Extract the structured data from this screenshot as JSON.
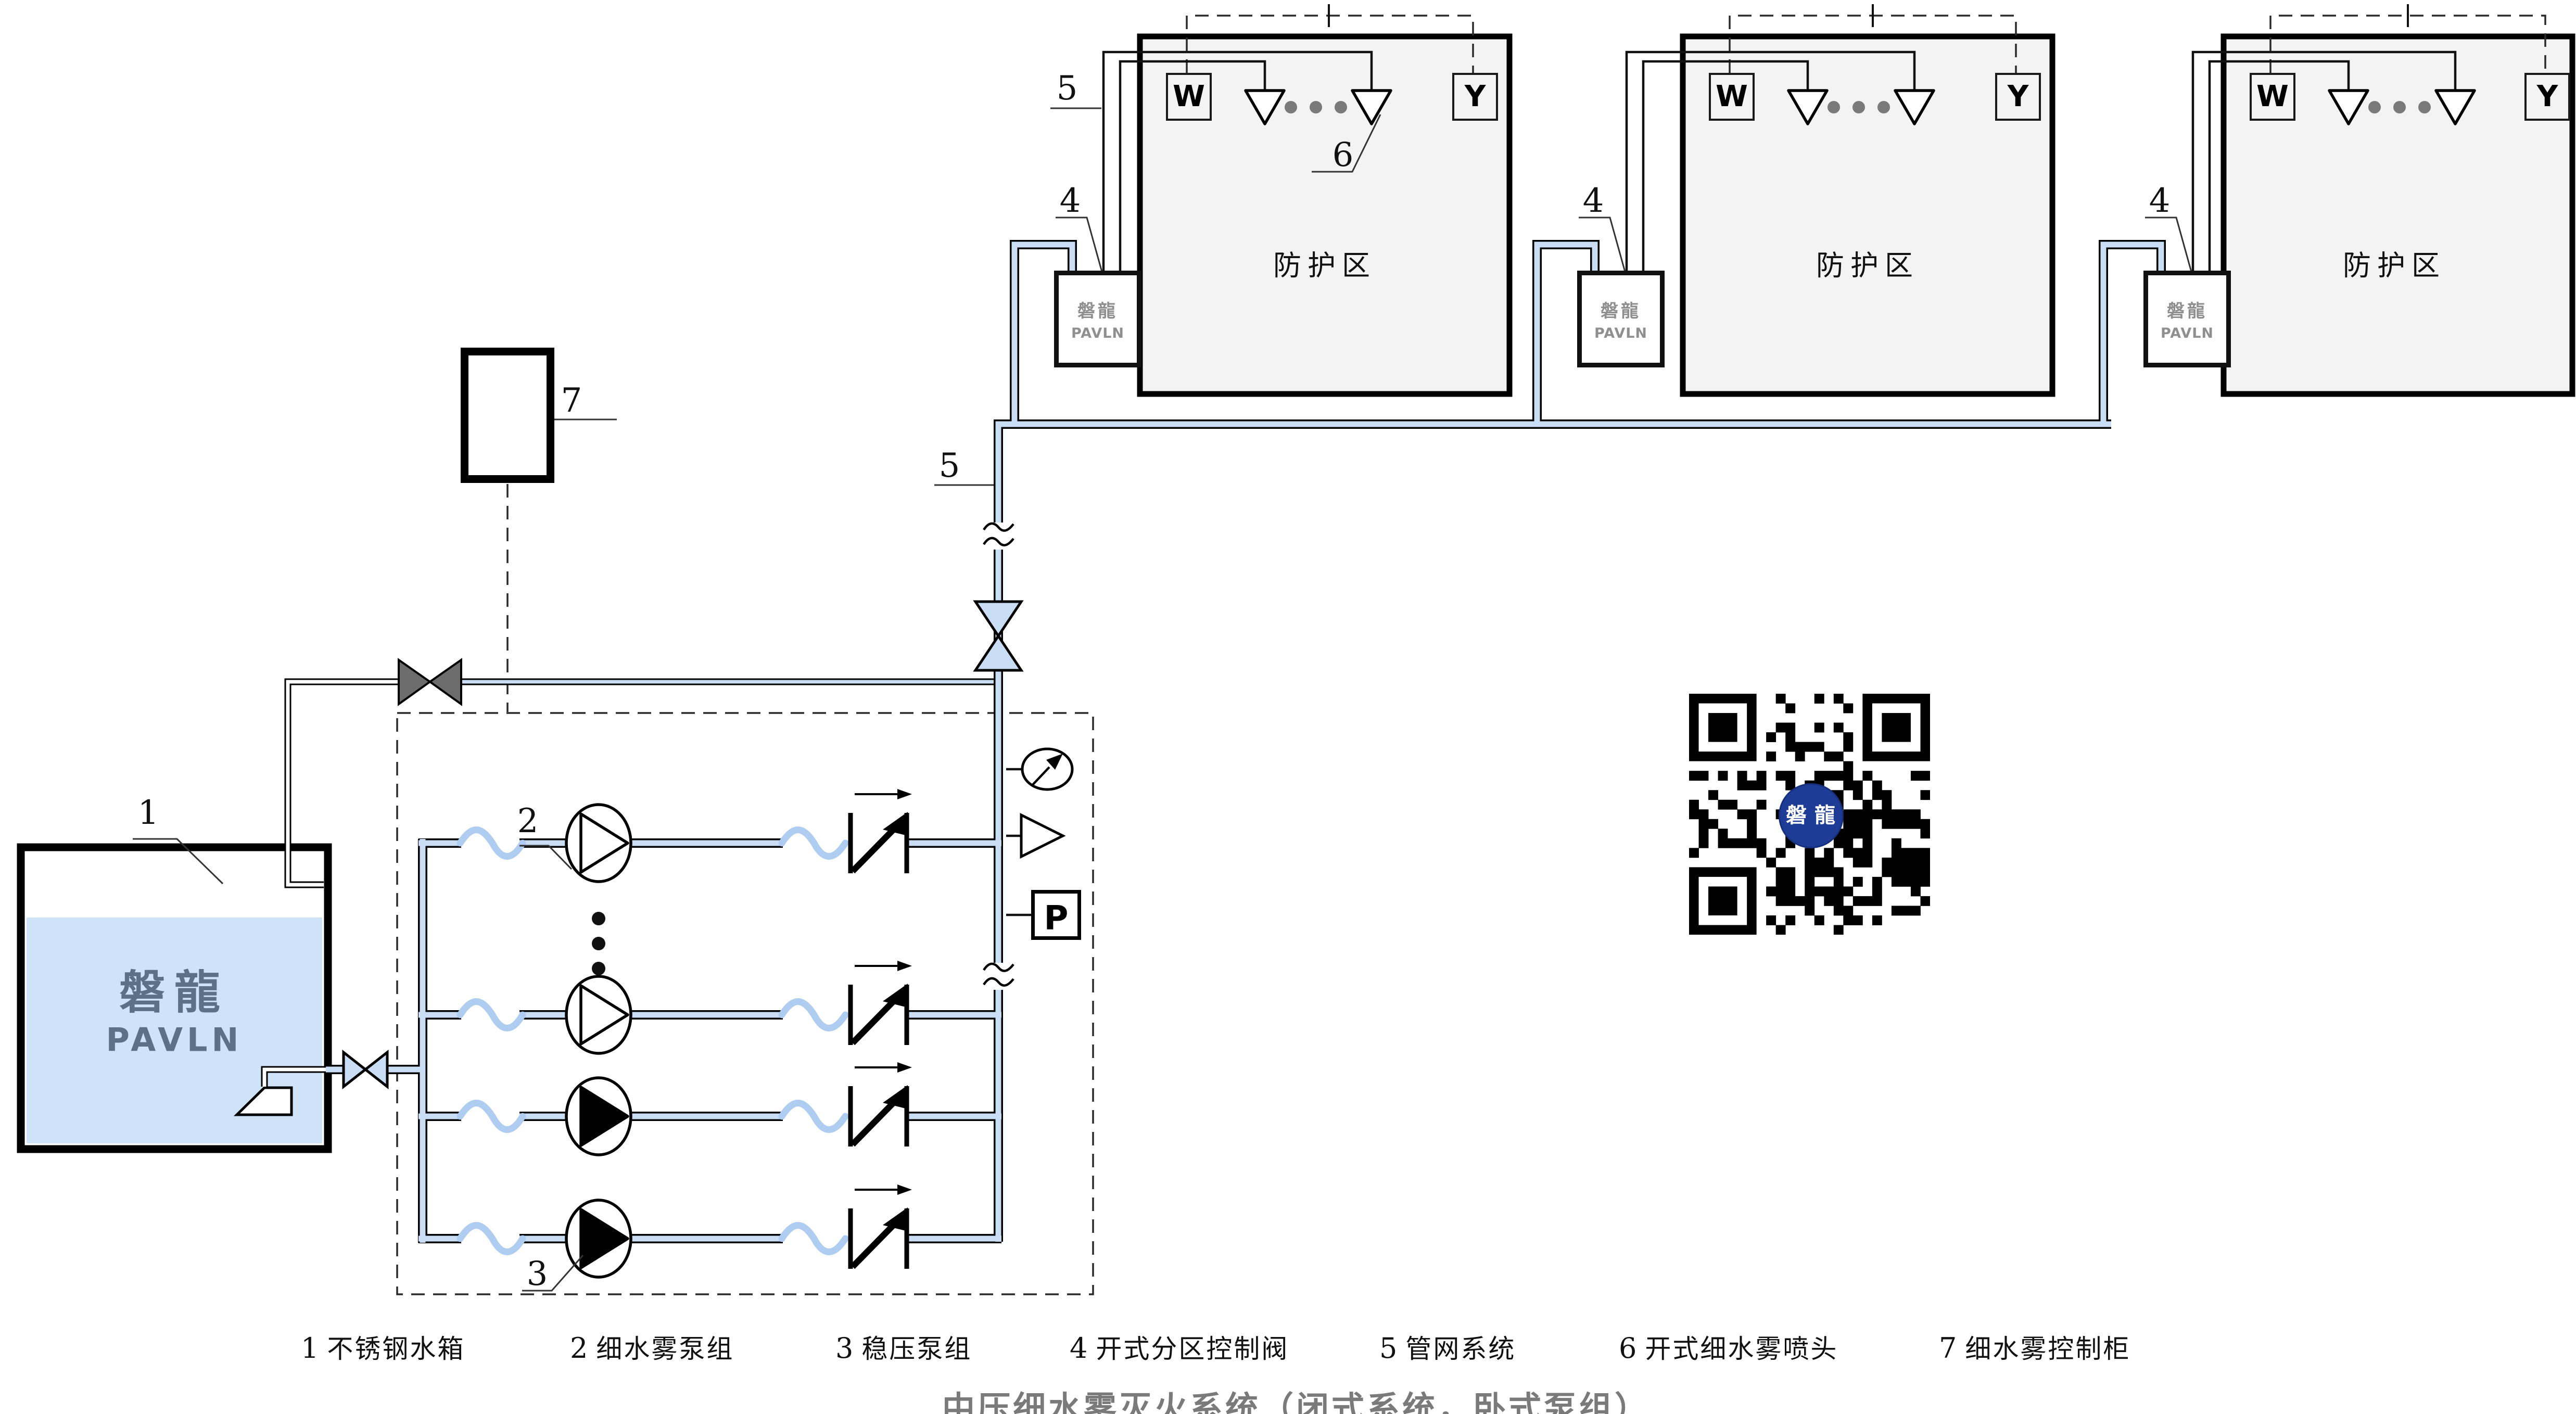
{
  "diagram_title": "中压细水雾灭火系统（闭式系统，卧式泵组）",
  "zone": {
    "name": "防护区",
    "w": "W",
    "y": "Y"
  },
  "brand": {
    "cn": "磐龍",
    "en": "PAVLN",
    "qr": "磐 龍"
  },
  "instruments": {
    "pressure_switch": "P"
  },
  "callouts": {
    "tank": "1",
    "mist_pump_group": "2",
    "stabilizing_pump_group": "3",
    "zone_control_valve": "4",
    "pipe_network": "5",
    "mist_nozzle": "6",
    "control_cabinet": "7"
  },
  "legend": {
    "items": [
      {
        "no": "1",
        "label": "不锈钢水箱"
      },
      {
        "no": "2",
        "label": "细水雾泵组"
      },
      {
        "no": "3",
        "label": "稳压泵组"
      },
      {
        "no": "4",
        "label": "开式分区控制阀"
      },
      {
        "no": "5",
        "label": "管网系统"
      },
      {
        "no": "6",
        "label": "开式细水雾喷头"
      },
      {
        "no": "7",
        "label": "细水雾控制柜"
      }
    ]
  },
  "colors": {
    "pipe_blue": "#c9ddf5",
    "hose_blue": "#aecdf0",
    "water": "#cfe3f8",
    "zone_fill": "#f3f3f3",
    "valve_gray": "#6c6c6c",
    "brand_gray": "#8f8f8f",
    "tank_brand": "#5d7186",
    "qr_navy": "#1e3c96",
    "title_gray": "#7a7a7a"
  }
}
